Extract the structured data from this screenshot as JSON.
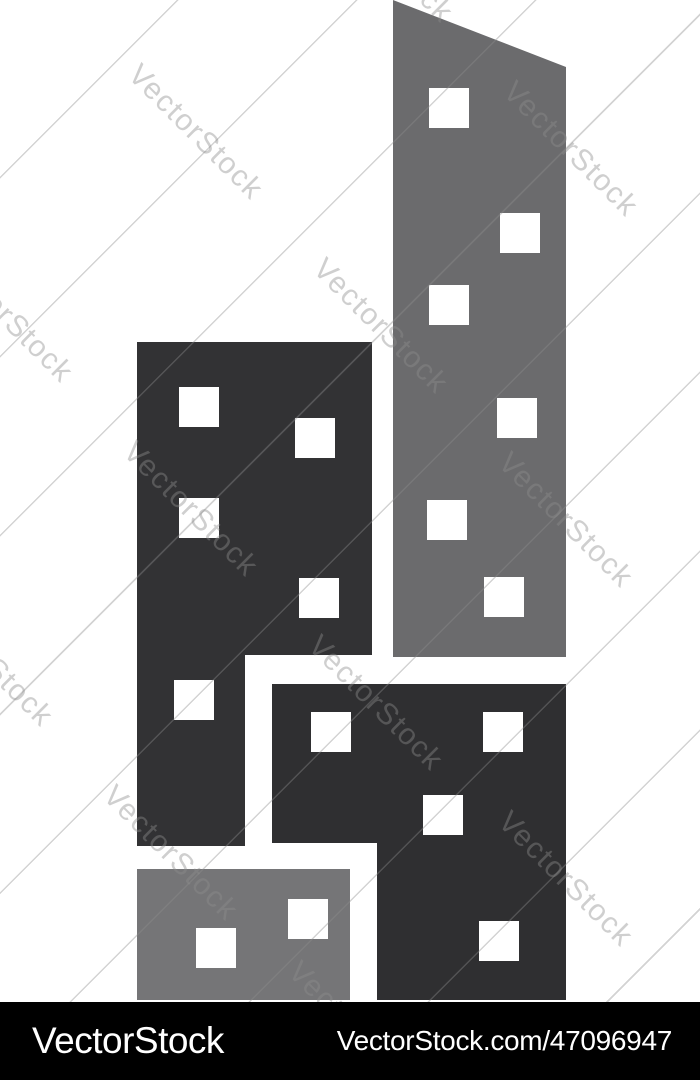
{
  "watermark": {
    "text": "VectorStock"
  },
  "footer": {
    "brand": "VectorStock",
    "url": "VectorStock.com/47096947",
    "bg": "#000000",
    "text_color": "#ffffff"
  },
  "artwork": {
    "description": "city-buildings-skyscrapers-icon",
    "background": "#ffffff",
    "window_color": "#ffffff",
    "window_size": 40,
    "buildings": [
      {
        "name": "tall-gray-building",
        "color": "#6b6b6d",
        "polygon": "393,0 566,67 566,657 393,657",
        "windows": [
          [
            429,
            88
          ],
          [
            500,
            213
          ],
          [
            429,
            285
          ],
          [
            497,
            398
          ],
          [
            427,
            500
          ],
          [
            484,
            577
          ]
        ]
      },
      {
        "name": "left-dark-building",
        "color": "#323234",
        "polygon": "137,342 372,342 372,655 245,655 245,846 137,846",
        "windows": [
          [
            179,
            387
          ],
          [
            295,
            418
          ],
          [
            179,
            498
          ],
          [
            299,
            578
          ],
          [
            174,
            680
          ]
        ]
      },
      {
        "name": "bottom-right-dark-building",
        "color": "#2f2f31",
        "polygon": "272,684 566,684 566,1000 377,1000 377,843 272,843",
        "windows": [
          [
            311,
            712
          ],
          [
            483,
            712
          ],
          [
            423,
            795
          ],
          [
            479,
            921
          ]
        ]
      },
      {
        "name": "bottom-left-gray-building",
        "color": "#757577",
        "polygon": "137,869 350,869 350,1000 137,1000",
        "windows": [
          [
            288,
            899
          ],
          [
            196,
            928
          ]
        ]
      }
    ]
  }
}
